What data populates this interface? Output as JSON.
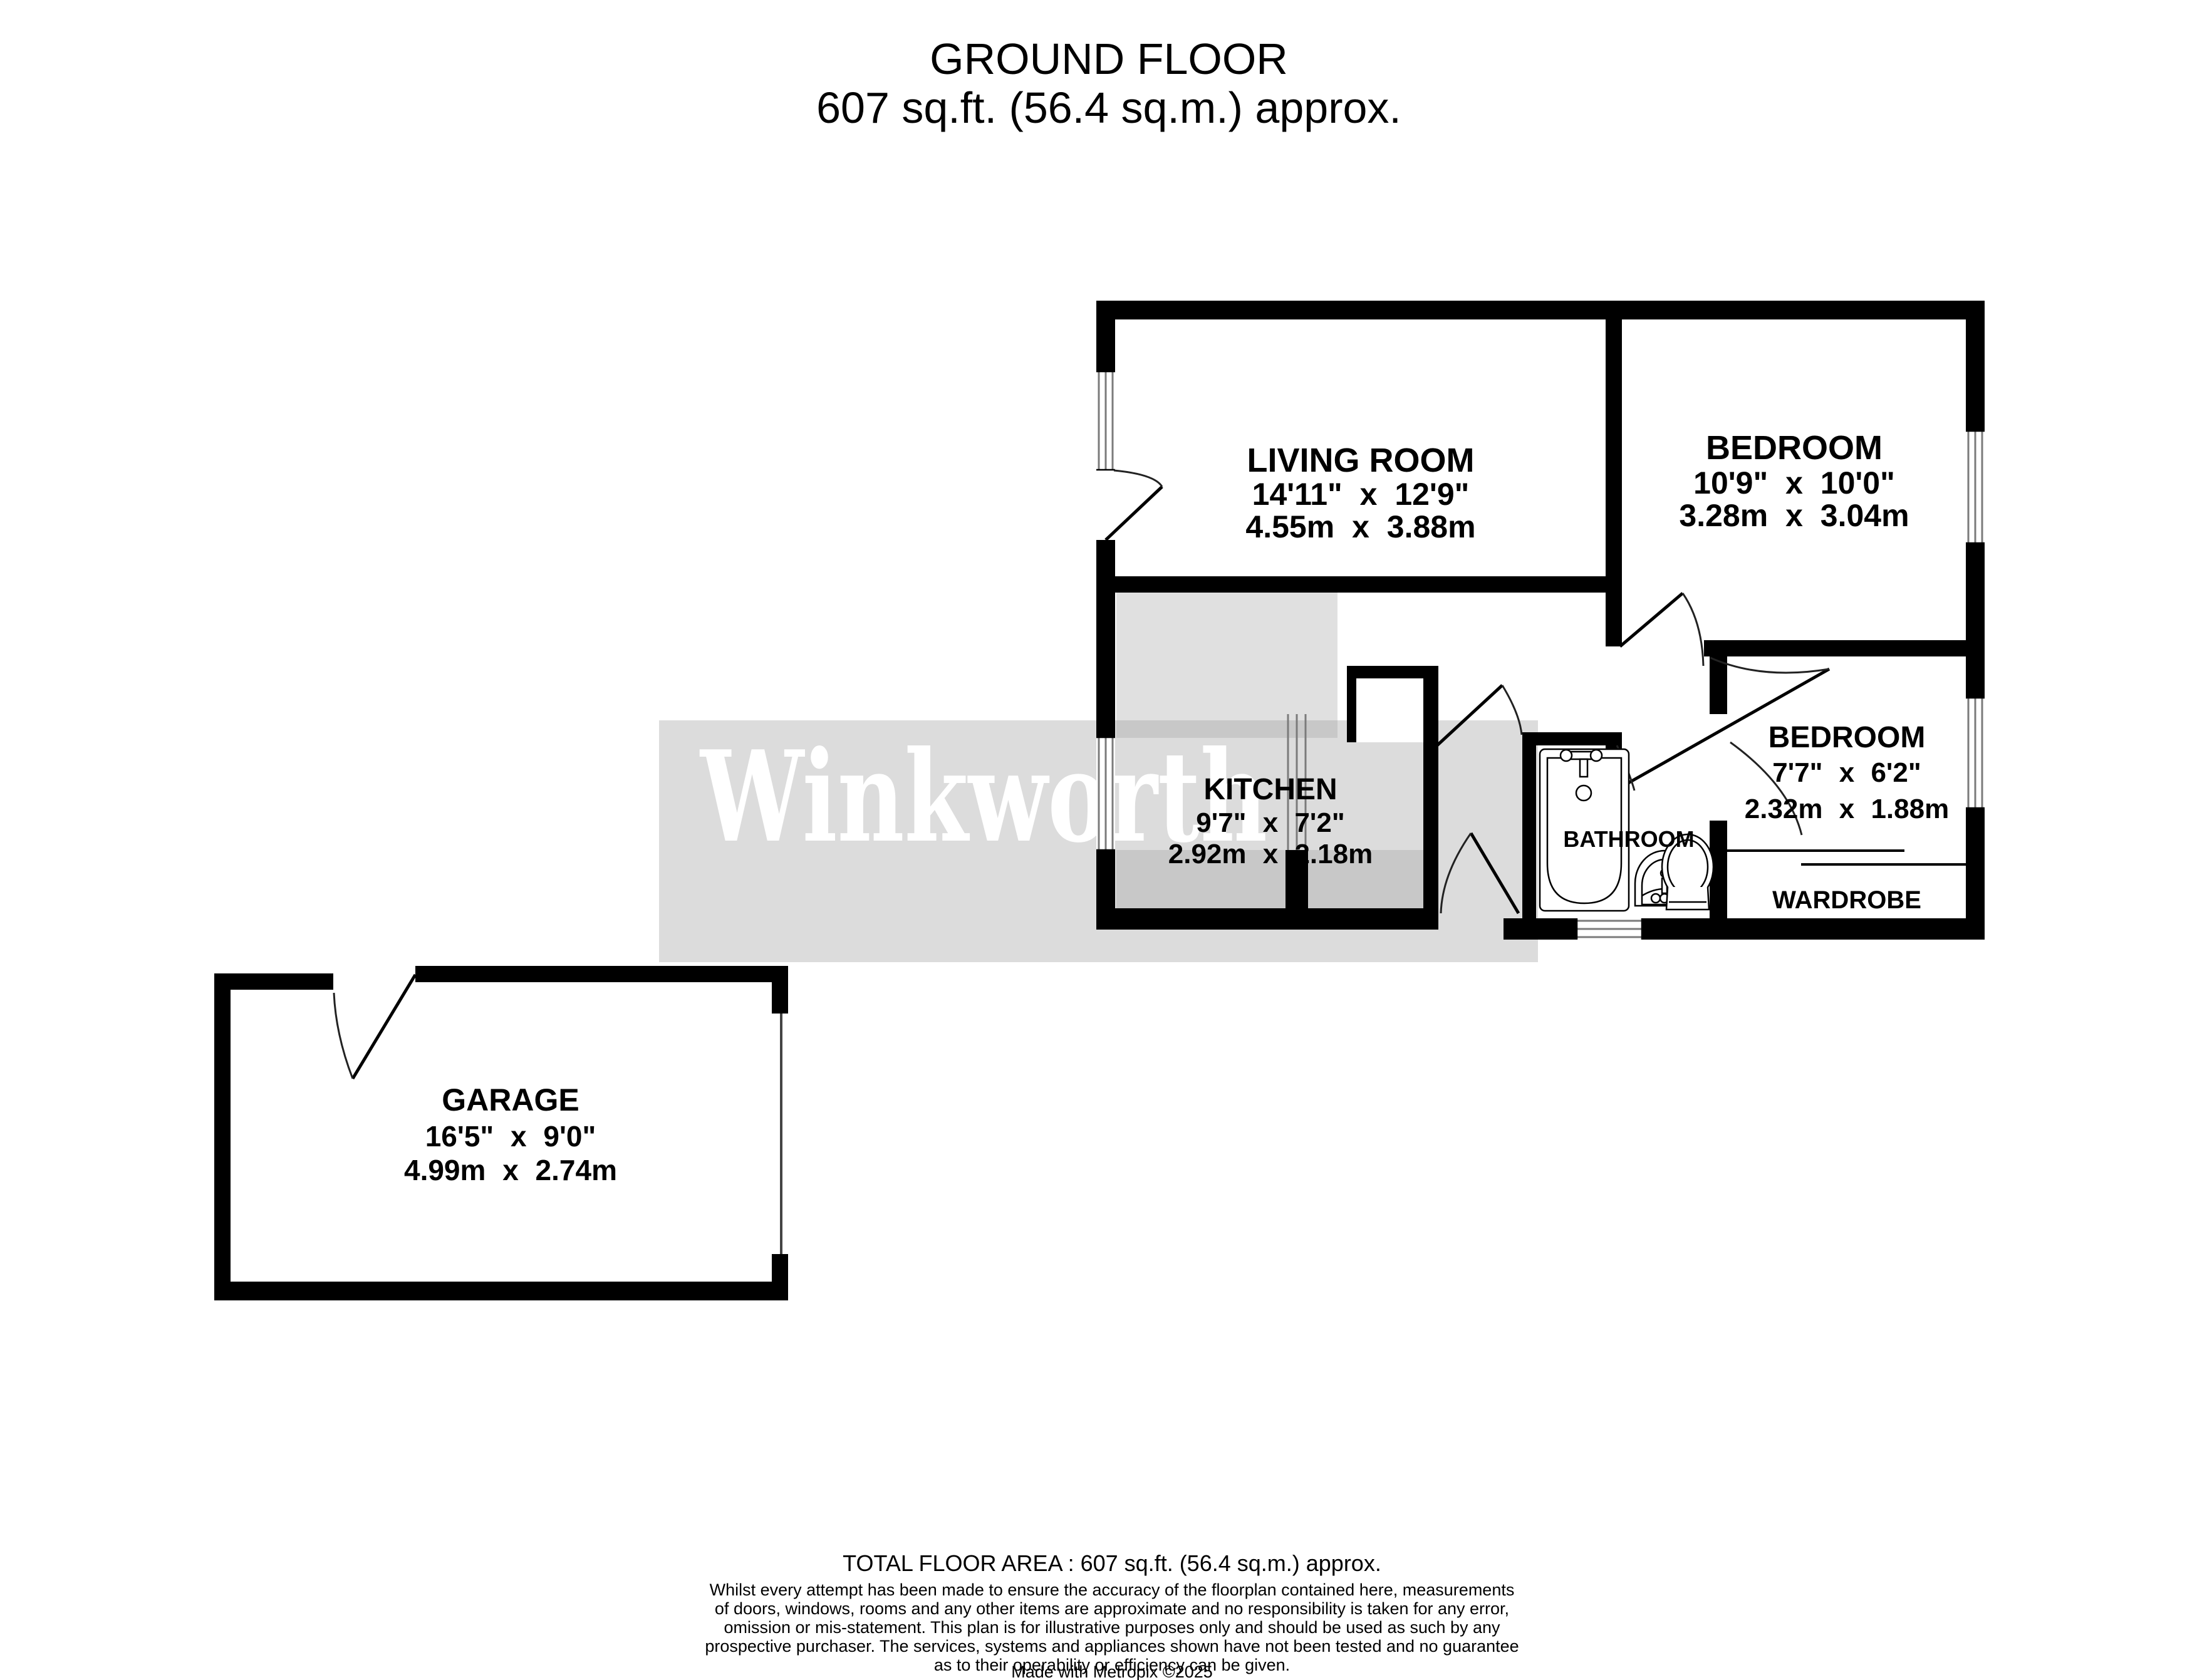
{
  "title": {
    "line1": "GROUND FLOOR",
    "line2": "607 sq.ft. (56.4 sq.m.) approx."
  },
  "watermark": {
    "text": "Winkworth"
  },
  "colors": {
    "wall": "#000000",
    "watermark_band": "#dcdcdc",
    "kitchen_fill": "#e0e0e0",
    "kitchen_counter": "#c8c8c8"
  },
  "rooms": {
    "living_room": {
      "name": "LIVING ROOM",
      "imperial": "14'11\" x 12'9\"",
      "metric": "4.55m x 3.88m"
    },
    "bedroom1": {
      "name": "BEDROOM",
      "imperial": "10'9\" x 10'0\"",
      "metric": "3.28m x 3.04m"
    },
    "kitchen": {
      "name": "KITCHEN",
      "imperial": "9'7\" x 7'2\"",
      "metric": "2.92m x 2.18m"
    },
    "bedroom2": {
      "name": "BEDROOM",
      "imperial": "7'7\" x 6'2\"",
      "metric": "2.32m x 1.88m"
    },
    "bathroom": {
      "name": "BATHROOM"
    },
    "wardrobe": {
      "name": "WARDROBE"
    },
    "garage": {
      "name": "GARAGE",
      "imperial": "16'5\" x 9'0\"",
      "metric": "4.99m x 2.74m"
    }
  },
  "footer": {
    "total": "TOTAL FLOOR AREA : 607 sq.ft. (56.4 sq.m.) approx.",
    "disclaimer": [
      "Whilst every attempt has been made to ensure the accuracy of the floorplan contained here, measurements",
      "of doors, windows, rooms and any other items are approximate and no responsibility is taken for any error,",
      "omission or mis-statement. This plan is for illustrative purposes only and should be used as such by any",
      "prospective purchaser. The services, systems and appliances shown have not been tested and no guarantee",
      "as to their operability or efficiency can be given."
    ],
    "credit": "Made with Metropix ©2025"
  }
}
